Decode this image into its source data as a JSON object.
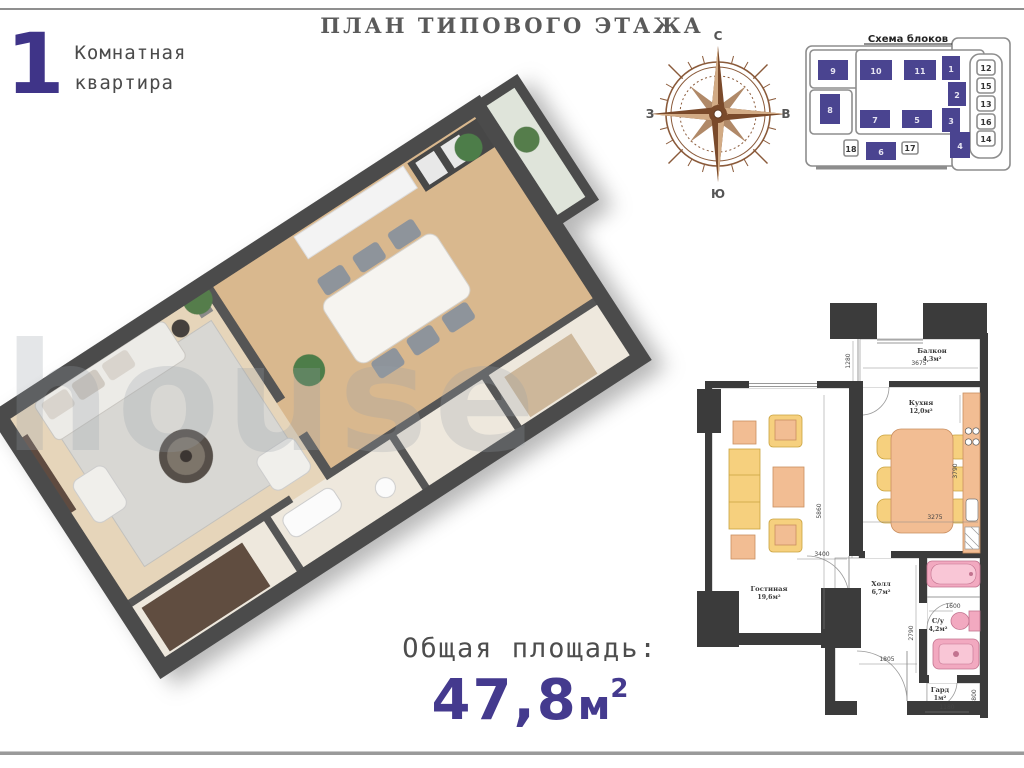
{
  "page": {
    "title": "ПЛАН ТИПОВОГО ЭТАЖА"
  },
  "colors": {
    "accent_purple": "#443a8e",
    "block_purple": "#4a4490",
    "wall_dark": "#3b3b3b"
  },
  "apartment": {
    "number": "1",
    "line1": "Комнатная",
    "line2": "квартира"
  },
  "compass": {
    "north": "С",
    "south": "Ю",
    "west": "З",
    "east": "В"
  },
  "block_scheme": {
    "title": "Схема блоков",
    "purple": [
      "9",
      "10",
      "11",
      "7",
      "5",
      "8",
      "6",
      "1",
      "2",
      "3",
      "4"
    ],
    "outline": [
      "12",
      "15",
      "13",
      "16",
      "14",
      "18",
      "17"
    ]
  },
  "plan3d": {
    "watermark": "house"
  },
  "plan2d": {
    "rooms": [
      {
        "name": "Балкон",
        "area": "4,3м²"
      },
      {
        "name": "Кухня",
        "area": "12,0м²"
      },
      {
        "name": "Гостиная",
        "area": "19,6м²"
      },
      {
        "name": "Холл",
        "area": "6,7м²"
      },
      {
        "name": "С/у",
        "area": "4,2м²"
      },
      {
        "name": "Гард",
        "area": "1м²"
      }
    ],
    "dims": {
      "balcony_w": "3675",
      "balcony_h": "1280",
      "living_h": "5860",
      "living_w": "3400",
      "kitchen_h": "3790",
      "kitchen_w": "3275",
      "hall_w": "1805",
      "bath_h": "2790",
      "bath_w": "1600",
      "ward_w": "1180",
      "ward_h": "800"
    }
  },
  "total": {
    "label": "Общая площадь:",
    "value": "47,8",
    "unit": "м",
    "sup": "2"
  }
}
